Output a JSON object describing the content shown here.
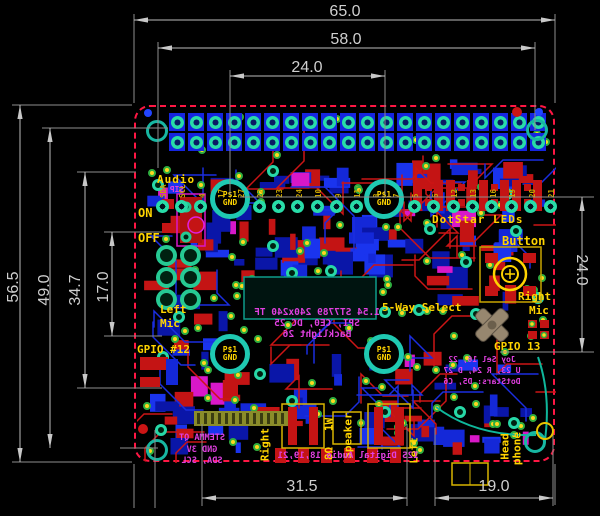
{
  "dims": {
    "width_total": "65.0",
    "width_holes": "58.0",
    "width_top": "24.0",
    "height_total": "56.5",
    "height_holes": "49.0",
    "height_mid": "34.7",
    "height_mic": "17.0",
    "height_right": "24.0",
    "width_bottom_left": "31.5",
    "width_bottom_right": "19.0"
  },
  "silkscreen": {
    "audio": "Audio",
    "on": "ON",
    "off": "OFF",
    "left_mic_line1": "Left",
    "left_mic_line2": "Mic",
    "gpio12": "GPIO #12",
    "dotstar_leds": "DotStar LEDs",
    "button": "Button",
    "right_mic_line1": "Right",
    "right_mic_line2": "Mic",
    "five_way_select": "5-Way Select",
    "gpio13": "GPIO 13",
    "speaker_right": "Right",
    "speaker_power": "1W",
    "speaker_impedance": "8Ω",
    "speaker": "Speaker",
    "speaker_left": "Left",
    "headphone_line1": "Head",
    "headphone_line2": "phone",
    "mount_hole_line1": "P$1",
    "mount_hole_line2": "GND",
    "smt": "SIP"
  },
  "mirrored_silk": {
    "display_line1": "1.54 ST7789 240x240 TF",
    "display_line2": "SPI, CE0, DC 25",
    "display_line3": "Backlight 26",
    "stemma_line1": "STEMMA QT",
    "stemma_line2": "GND 3V",
    "stemma_line3": "SDA, SCL",
    "i2s": "I2S Digital Audio 18,19,21",
    "joystick_line1": "Joy Sel 16, 22",
    "joystick_line2": "U 23, R 24, D 27",
    "joystick_line3": "DotStars: D5, C6"
  },
  "breakout_labels": [
    "SDA",
    "SCL",
    "4",
    "17",
    "27",
    "22",
    "23",
    "24",
    "10",
    "9",
    "11",
    "8",
    "7",
    "5",
    "6",
    "12",
    "13",
    "16",
    "19",
    "20",
    "21"
  ],
  "colors": {
    "board_outline": "#ff1744",
    "silk_yellow": "#ffd400",
    "silk_magenta": "#e040e0",
    "copper_top": "#cc1515",
    "copper_bottom": "#1b2ee0",
    "pad_teal": "#28dca8",
    "via_ring": "#2fae3f",
    "via_center": "#ffd71e",
    "dimension_text": "#cfcfcf"
  }
}
